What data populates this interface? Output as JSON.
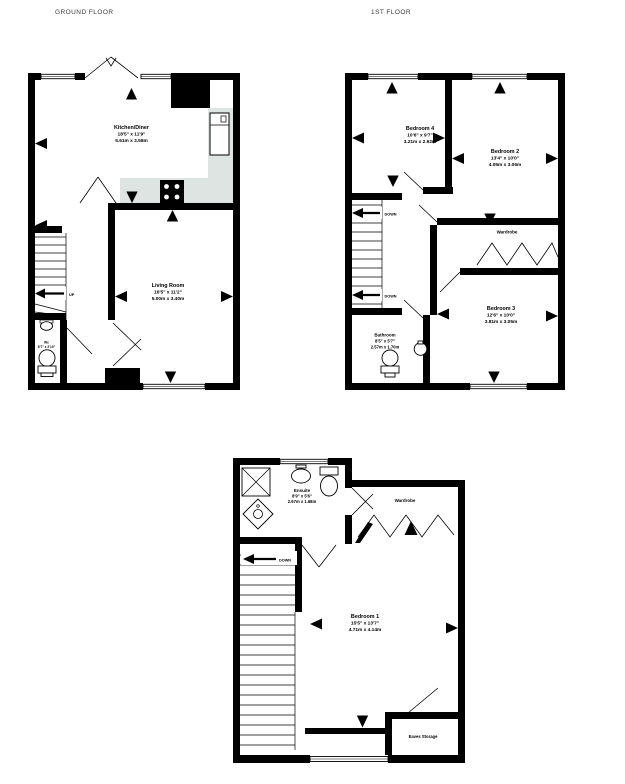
{
  "page": {
    "background": "#ffffff"
  },
  "colors": {
    "wall": "#000000",
    "counter": "#dde4e2",
    "text": "#000000",
    "title": "#3a3a3a"
  },
  "floors": {
    "ground": {
      "title": "GROUND FLOOR",
      "stairs_label": "UP",
      "rooms": {
        "kitchen": {
          "name": "Kitchen/Diner",
          "ft": "18'5\" x 11'9\"",
          "m": "5.61m x 3.58m"
        },
        "living": {
          "name": "Living Room",
          "ft": "16'5\" x 11'2\"",
          "m": "5.00m x 3.40m"
        },
        "wc": {
          "name": "Wc",
          "ft": "6'7\" x 2'10\""
        }
      }
    },
    "first": {
      "title": "1ST FLOOR",
      "stairs_label_upper": "DOWN",
      "stairs_label_lower": "DOWN",
      "rooms": {
        "bedroom4": {
          "name": "Bedroom 4",
          "ft": "10'6\" x 9'7\"",
          "m": "3.21m x 2.92m"
        },
        "bedroom2": {
          "name": "Bedroom 2",
          "ft": "13'4\" x 10'0\"",
          "m": "4.05m x 3.05m"
        },
        "bedroom3": {
          "name": "Bedroom 3",
          "ft": "12'6\" x 10'0\"",
          "m": "3.81m x 3.05m"
        },
        "bathroom": {
          "name": "Bathroom",
          "ft": "8'5\" x 5'7\"",
          "m": "2.57m x 1.70m"
        },
        "wardrobe": {
          "name": "Wardrobe"
        }
      }
    },
    "second": {
      "stairs_label": "DOWN",
      "rooms": {
        "ensuite": {
          "name": "Ensuite",
          "ft": "8'9\" x 5'6\"",
          "m": "2.67m x 1.68m"
        },
        "bedroom1": {
          "name": "Bedroom 1",
          "ft": "15'5\" x 13'7\"",
          "m": "4.71m x 4.14m"
        },
        "wardrobe": {
          "name": "Wardrobe"
        },
        "eaves": {
          "name": "Eaves Storage"
        }
      }
    }
  }
}
